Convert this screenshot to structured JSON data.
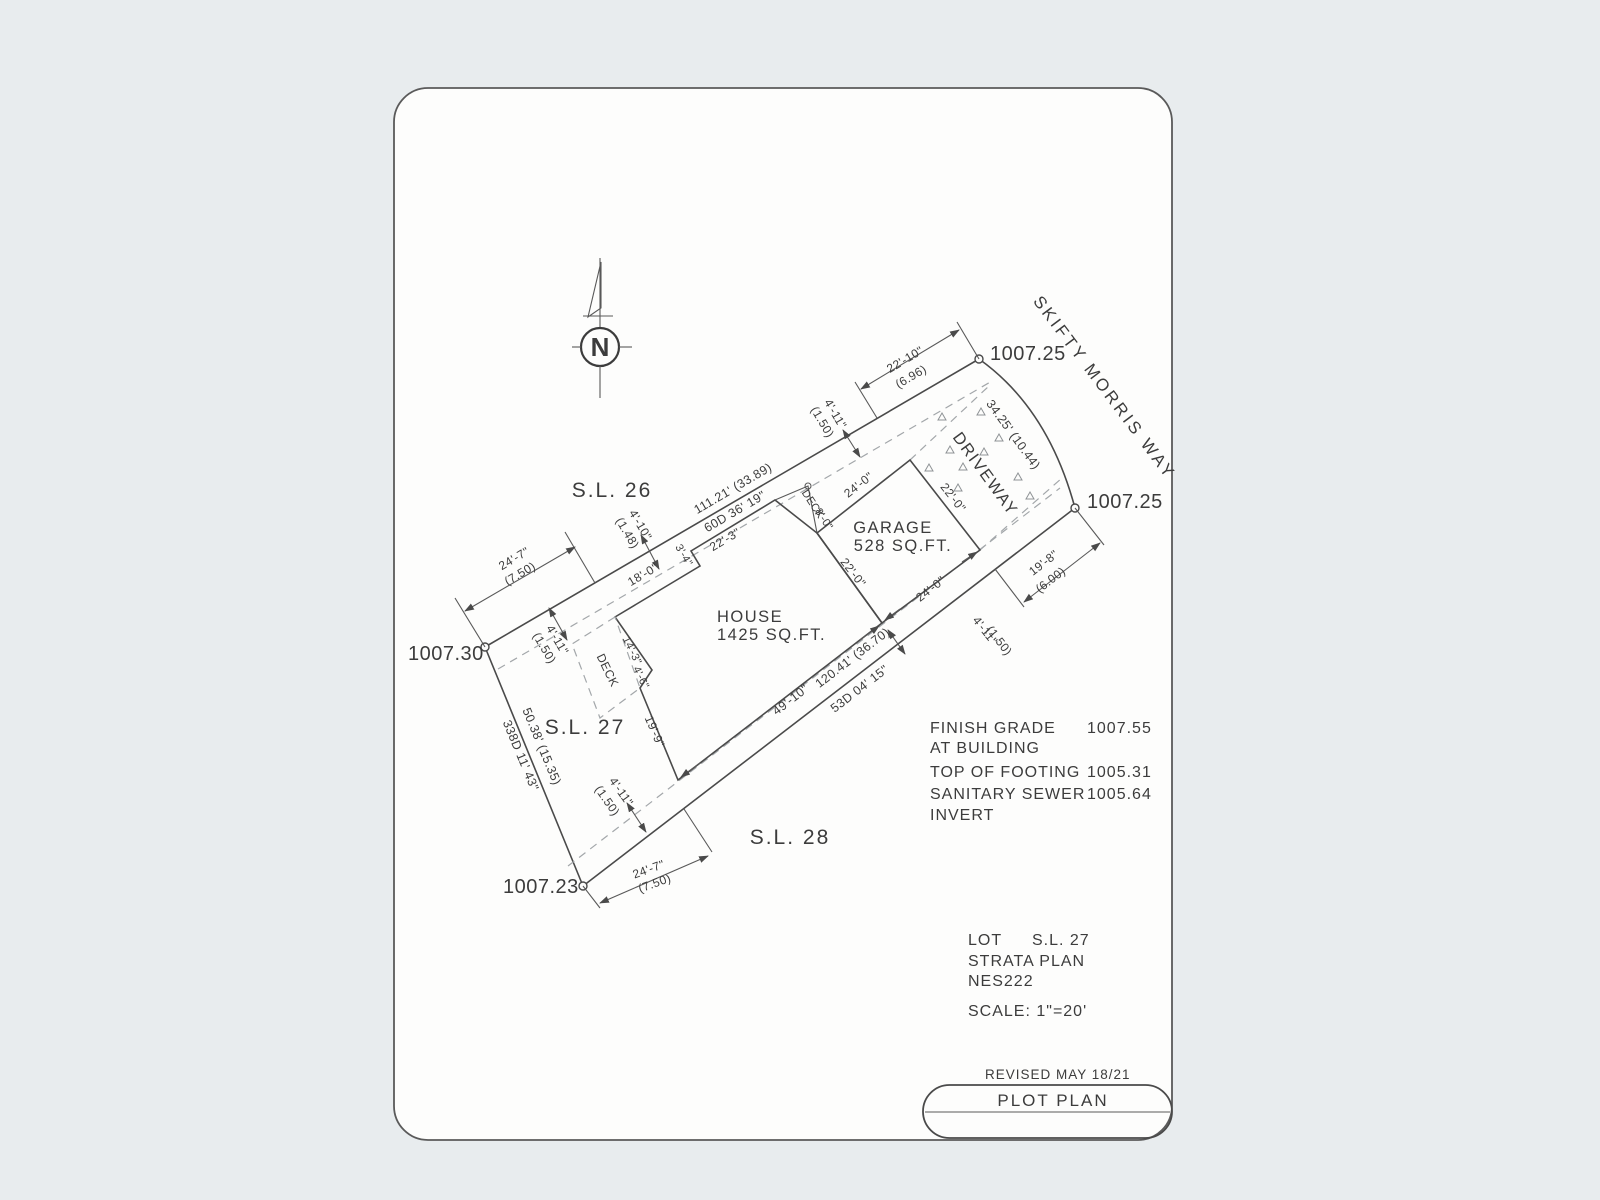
{
  "north": {
    "label": "N"
  },
  "street": {
    "name": "SKIFTY MORRIS WAY"
  },
  "lots": {
    "sl26": "S.L. 26",
    "sl27": "S.L. 27",
    "sl28": "S.L. 28"
  },
  "elevations": {
    "top": "1007.25",
    "right": "1007.25",
    "left": "1007.30",
    "bottom": "1007.23"
  },
  "buildings": {
    "house_label": "HOUSE",
    "house_area": "1425 SQ.FT.",
    "garage_label": "GARAGE",
    "garage_area": "528 SQ.FT.",
    "deck_west": "DECK",
    "deck_front": "DECK",
    "driveway": "DRIVEWAY"
  },
  "boundaries": {
    "nw_length": "111.21' (33.89)",
    "nw_bearing": "60D 36' 19\"",
    "arc_length": "34.25' (10.44)",
    "se_partial": "49'-10\"",
    "se_length": "120.41' (36.70)",
    "se_bearing": "53D 04' 15\"",
    "sw_length": "50.38' (15.35)",
    "sw_bearing": "338D 11' 43\""
  },
  "dims": {
    "d24_7": "24'-7\"",
    "m7_50": "(7.50)",
    "d4_11": "4'-11\"",
    "m1_50": "(1.50)",
    "d4_10": "4'-10\"",
    "m1_48": "(1.48)",
    "d22_10": "22'-10\"",
    "m6_96": "(6.96)",
    "d22_3": "22'-3\"",
    "d3_4": "3'-4\"",
    "d18_0": "18'-0\"",
    "d14_3": "14'-3\"",
    "d4_6": "4'-6\"",
    "d19_9": "19'-9\"",
    "d19_8": "19'-8\"",
    "m6_00": "(6.00)",
    "d24_0": "24'-0\"",
    "d22_0": "22'-0\"",
    "d8_0": "8'-0\""
  },
  "notes": {
    "finish_grade_1": "FINISH GRADE",
    "finish_grade_2": "AT BUILDING",
    "finish_grade_value": "1007.55",
    "footing_label": "TOP OF FOOTING",
    "footing_value": "1005.31",
    "sewer_1": "SANITARY SEWER",
    "sewer_2": "INVERT",
    "sewer_value": "1005.64"
  },
  "title_info": {
    "lot_label": "LOT",
    "lot_value": "S.L. 27",
    "strata_1": "STRATA PLAN",
    "strata_2": "NES222",
    "scale": "SCALE: 1\"=20'"
  },
  "title_block": {
    "revised": "REVISED MAY 18/21",
    "title": "PLOT PLAN"
  }
}
